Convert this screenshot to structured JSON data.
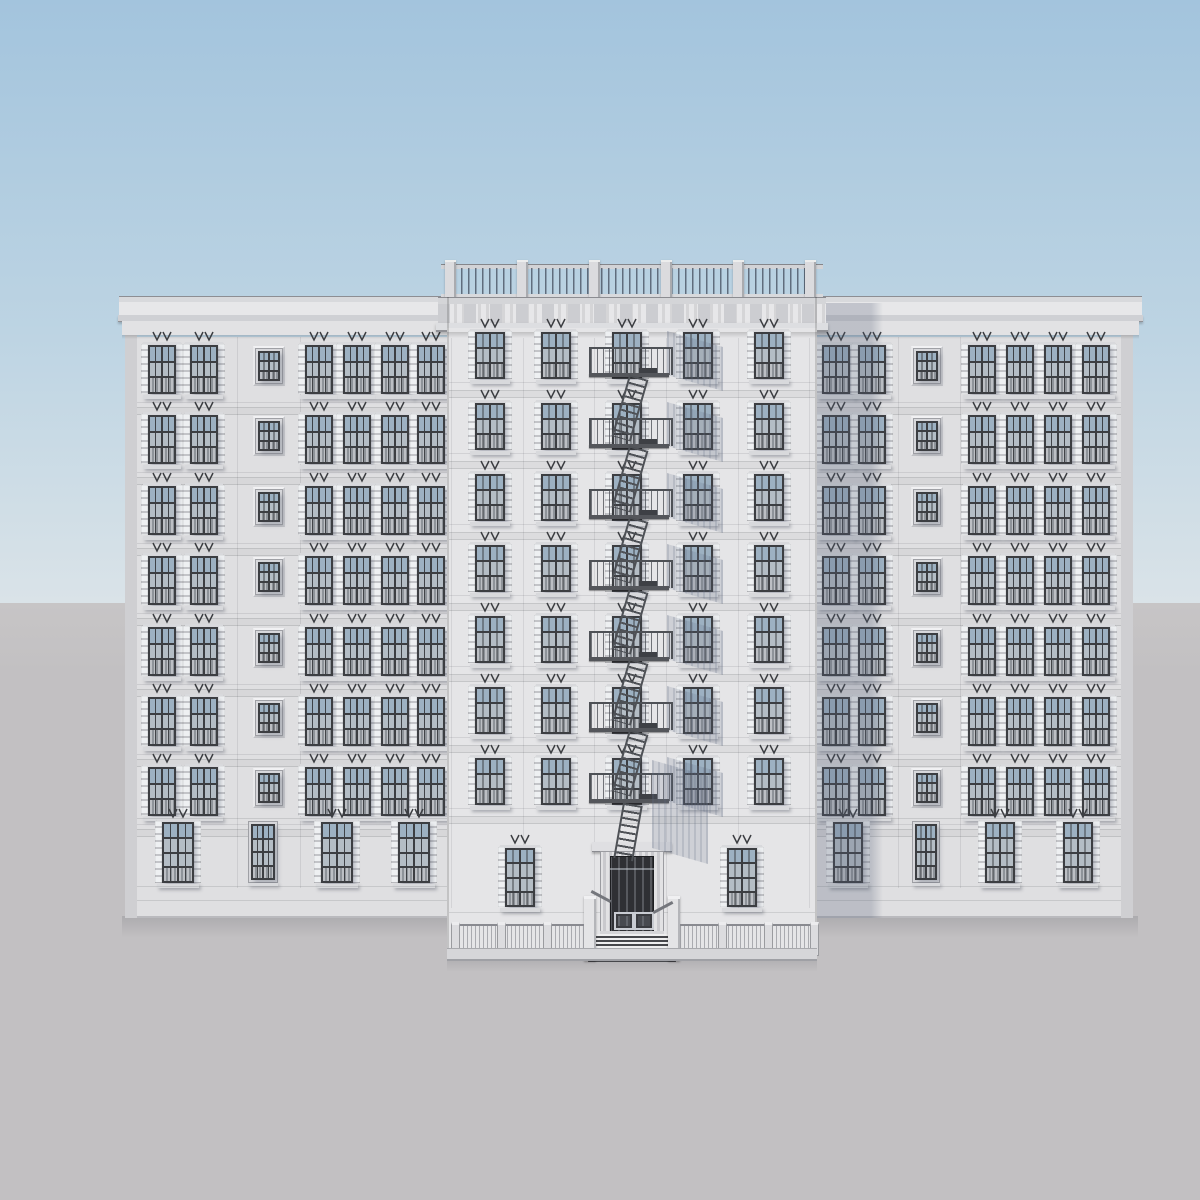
{
  "scene": {
    "palette": {
      "sky_top": "#a3c4dd",
      "sky_mid": "#bdd4e3",
      "sky_horizon": "#dae3e8",
      "ground_top": "#c7c5c6",
      "ground": "#c2c0c2",
      "facade_wing": "#dfdfe1",
      "facade_tower": "#e5e5e7",
      "side_face": "#cfcfd2",
      "frame": "#3c3e42",
      "pane_top": "#9db1c2",
      "pane_mid": "#b4bdc5",
      "pane_low": "#8e9399",
      "quoin": "#eef0f2",
      "quoin_gap": "#c3c4c8",
      "trim": "#d8d9dc",
      "metal": "#4e5156",
      "cornice_light": "#e7e7e9",
      "cornice_mid": "#cccdd1",
      "cast_shadow": "rgba(86,97,120,0.26)",
      "soft_shadow": "rgba(96,106,128,0.17)"
    },
    "sky": {
      "horizon_y": 603
    },
    "left_wing": {
      "sliver": {
        "x": 125,
        "y": 312,
        "w": 12,
        "h": 606
      },
      "facade": {
        "x": 137,
        "y": 337,
        "w": 310,
        "h": 581
      },
      "cornice": {
        "x": 119,
        "y": 296,
        "w": 332
      },
      "rows": [
        345,
        415,
        486,
        556,
        627,
        697,
        767
      ],
      "win_w": 28,
      "win_h": 48,
      "pair": [
        148,
        190
      ],
      "small_x": 256,
      "quad": [
        305,
        343,
        381,
        417
      ],
      "seams": [
        237,
        300
      ],
      "ground": {
        "y": 822,
        "h": 60,
        "quoined": [
          [
            162,
            32
          ],
          [
            321,
            32
          ],
          [
            398,
            32
          ]
        ],
        "plain": [
          [
            251,
            24
          ]
        ]
      },
      "plinth_lines": [
        886,
        900
      ],
      "bottom": 918
    },
    "right_wing": {
      "sliver": {
        "x": 1121,
        "y": 312,
        "w": 12,
        "h": 606
      },
      "facade": {
        "x": 817,
        "y": 337,
        "w": 304,
        "h": 581
      },
      "cornice": {
        "x": 810,
        "y": 296,
        "w": 332
      },
      "rows": [
        345,
        415,
        486,
        556,
        627,
        697,
        767
      ],
      "win_w": 28,
      "win_h": 48,
      "pair": [
        822,
        858
      ],
      "small_x": 914,
      "quad": [
        968,
        1006,
        1044,
        1082
      ],
      "seams": [
        898,
        960
      ],
      "ground": {
        "y": 822,
        "h": 60,
        "quoined": [
          [
            833,
            30
          ],
          [
            985,
            30
          ],
          [
            1063,
            30
          ]
        ],
        "plain": [
          [
            915,
            22
          ]
        ]
      },
      "plinth_lines": [
        886,
        900
      ],
      "bottom": 918,
      "tower_shadow": {
        "x": 817,
        "y": 303,
        "w": 66,
        "h": 615
      }
    },
    "tower": {
      "facade": {
        "x": 447,
        "y": 328,
        "w": 370,
        "h": 622
      },
      "balustrade": {
        "rail": {
          "x": 441,
          "y": 264,
          "w": 382,
          "h": 4
        },
        "balusters": {
          "x": 447,
          "y": 268,
          "w": 370,
          "h": 26
        },
        "base": {
          "x": 441,
          "y": 294,
          "w": 382,
          "h": 5
        },
        "posts": [
          445,
          517,
          589,
          661,
          733,
          805
        ],
        "post_w": 11,
        "post_y": 260,
        "post_h": 38
      },
      "roof_slab": {
        "x": 438,
        "y": 297,
        "w": 388,
        "h": 7
      },
      "dentil_band": {
        "x": 438,
        "y": 304,
        "w": 388,
        "h": 19
      },
      "ledge": {
        "x": 436,
        "y": 323,
        "w": 392,
        "h": 7
      },
      "rows": [
        332,
        403,
        474,
        545,
        616,
        687,
        758
      ],
      "win_w": 30,
      "win_h": 46,
      "cols": [
        475,
        541,
        612,
        683,
        754
      ],
      "seams": [
        451,
        523,
        594,
        666,
        738,
        809
      ],
      "ground_windows": [
        [
          505,
          30,
          848,
          58
        ],
        [
          727,
          30,
          848,
          58
        ]
      ],
      "basement_line_y": 912,
      "bottom": 950
    },
    "fire_escape": {
      "x": 589,
      "w": 80,
      "rail_h": 26,
      "platforms": [
        373,
        444,
        515,
        586,
        657,
        728,
        799
      ],
      "ladder": {
        "x": 620,
        "w": 16,
        "len": 64,
        "tilt_deg": 16
      },
      "drop_ladder": {
        "x": 618,
        "y": 804,
        "w": 16,
        "h": 56
      },
      "shadow": {
        "dx": 78,
        "w": 56,
        "h": 44
      }
    },
    "entrance": {
      "cornice": {
        "x": 592,
        "y": 842,
        "w": 80,
        "h": 9
      },
      "surround": {
        "x": 600,
        "y": 851,
        "w": 64,
        "h": 84
      },
      "door": {
        "x": 610,
        "y": 856,
        "w": 44,
        "h": 78
      },
      "hardware_y": 912,
      "steps": {
        "x": 588,
        "y": 934,
        "w": 88,
        "h": 28
      },
      "newels": [
        584,
        668
      ],
      "newel_w": 12,
      "newel_y": 896,
      "newel_h": 62
    },
    "fence": {
      "y": 924,
      "h": 26,
      "segments": [
        {
          "x": 451,
          "w": 133
        },
        {
          "x": 680,
          "w": 133
        }
      ],
      "posts": [
        451,
        497,
        543,
        718,
        764,
        810
      ],
      "post_w": 7,
      "post_y": 922,
      "post_h": 30,
      "curb": {
        "x": 447,
        "y": 948,
        "w": 370,
        "h": 10
      }
    },
    "ground_shadows": [
      {
        "x": 122,
        "y": 916,
        "w": 1016,
        "h": 22
      },
      {
        "x": 447,
        "y": 956,
        "w": 370,
        "h": 16
      }
    ]
  }
}
